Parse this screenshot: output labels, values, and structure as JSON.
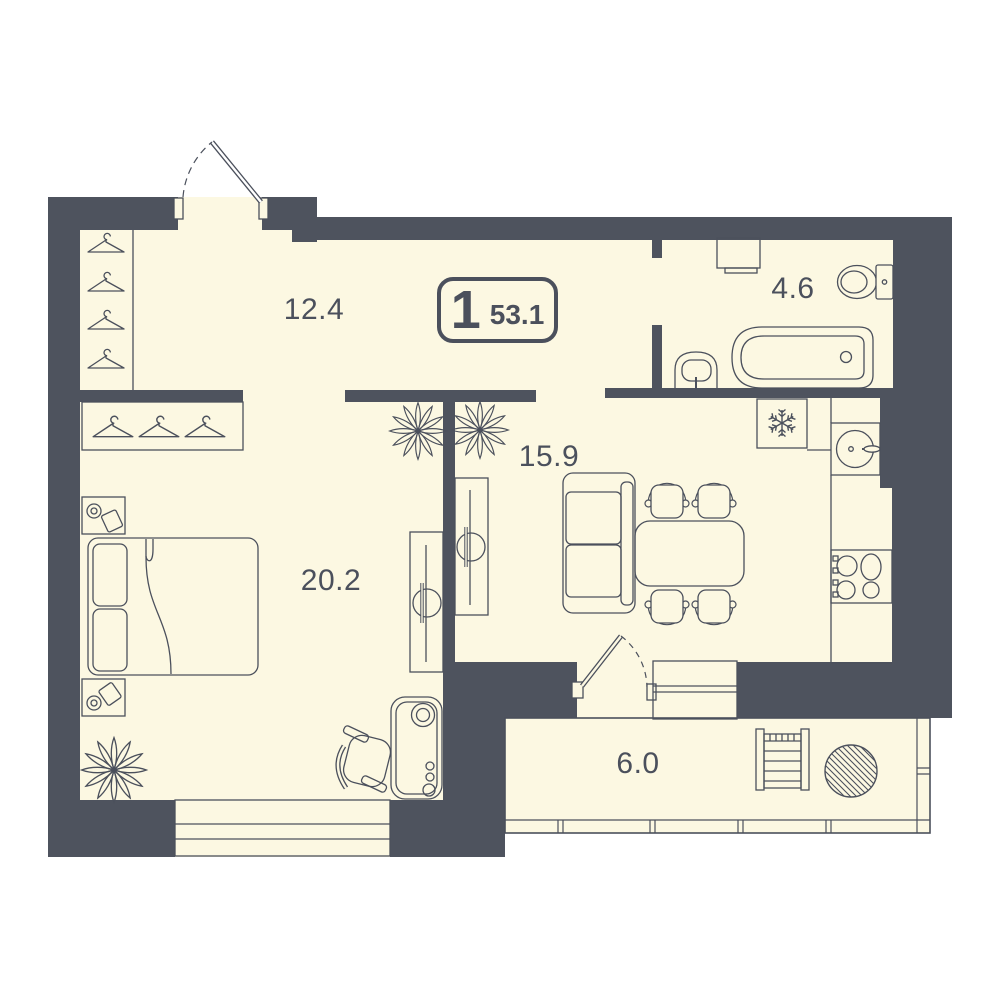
{
  "plan": {
    "badge": {
      "rooms_count": "1",
      "total_area": "53.1"
    },
    "rooms": [
      {
        "name": "hallway",
        "area": "12.4"
      },
      {
        "name": "bathroom",
        "area": "4.6"
      },
      {
        "name": "living-room",
        "area": "15.9"
      },
      {
        "name": "bedroom",
        "area": "20.2"
      },
      {
        "name": "balcony",
        "area": "6.0"
      }
    ],
    "furniture": [
      "entrance-door",
      "closet-hangers",
      "wardrobe-hangers",
      "washing-machine",
      "toilet",
      "bathtub",
      "bathroom-sink",
      "fridge-snowflake",
      "kitchen-sink",
      "stove",
      "sofa",
      "dining-table",
      "dining-chairs",
      "sliding-doors",
      "plants",
      "bed",
      "nightstands",
      "desk",
      "office-chair",
      "balcony-door",
      "window",
      "drying-rack",
      "balcony-table"
    ],
    "colors": {
      "wall": "#4e535e",
      "floor": "#fcf8e2",
      "line": "#4b505c",
      "background": "#ffffff"
    }
  }
}
